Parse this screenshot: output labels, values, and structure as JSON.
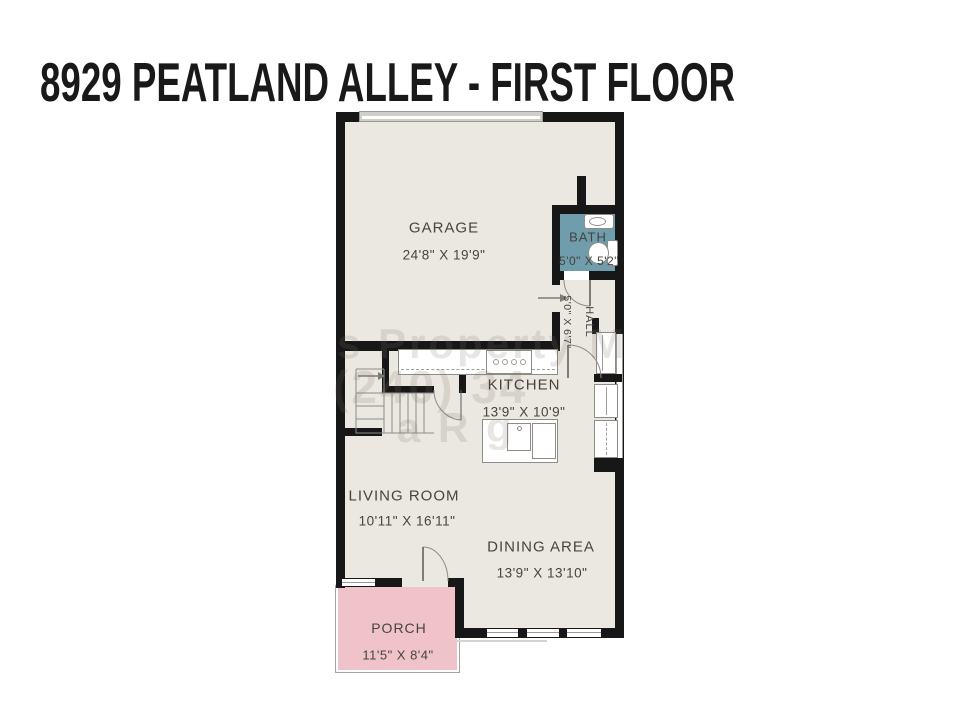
{
  "title": "8929 PEATLAND ALLEY - FIRST FLOOR",
  "colors": {
    "wall": "#171717",
    "floor": "#ebe8e1",
    "bath": "#6f9dab",
    "porch": "#efc3c9",
    "label": "#45443e",
    "title": "#191919",
    "watermark": "rgba(125,118,106,0.18)"
  },
  "rooms": {
    "garage": {
      "label": "GARAGE",
      "dims": "24'8\" X 19'9\""
    },
    "bath": {
      "label": "BATH",
      "dims": "5'0\" X 5'2\""
    },
    "hall": {
      "label": "HALL",
      "dims": "5'0\" X 6'7\""
    },
    "kitchen": {
      "label": "KITCHEN",
      "dims": "13'9\" X 10'9\""
    },
    "living": {
      "label": "LIVING ROOM",
      "dims": "10'11\" X 16'11\""
    },
    "dining": {
      "label": "DINING AREA",
      "dims": "13'9\" X 13'10\""
    },
    "porch": {
      "label": "PORCH",
      "dims": "11'5\" X 8'4\""
    }
  },
  "watermark": {
    "line1": "s Property Man",
    "line2": "(240) 34",
    "line3": "a R g"
  }
}
